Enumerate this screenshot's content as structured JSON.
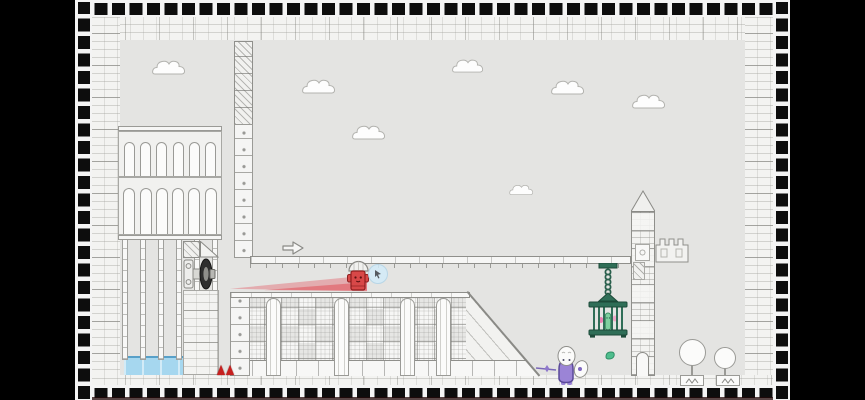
{
  "meta": {
    "app": "2d-platformer-game-scene",
    "scene_description": "Hand-drawn monochrome castle level with black letterbox bars, checkered tile border, brick frame walls, left aqueduct with arches and water pools, a cannon that launched a red player character along a pink dash trail, a suspended walkway with a right-arrow sign, a hanging green cage with captives, a brick tower with battlements, red spikes, a purple NPC with a sword, balloon trees and clouds",
    "visible_text": "none"
  },
  "palette": {
    "letterbox": "#000000",
    "checker_dark": "#0d0d0d",
    "sky": "#e4e4e2",
    "outline": "#8f8f8b",
    "white_fill": "#f9f9f8",
    "water_fill": "#a6d7ef",
    "water_edge": "#58a0c8",
    "spike_red": "#c6201f",
    "player_red": "#d84848",
    "trail_pink": "rgba(226,70,80,0.35)",
    "cage_green": "#2f6e57",
    "captive_green": "#7fcf9f",
    "captive_pink": "#e87fb0",
    "purple_body": "#9b84d6",
    "purple_outline": "#5b4a99"
  },
  "scene": {
    "clouds": [
      {
        "x": 77,
        "y": 58,
        "w": 34
      },
      {
        "x": 227,
        "y": 77,
        "w": 34
      },
      {
        "x": 377,
        "y": 57,
        "w": 32
      },
      {
        "x": 476,
        "y": 78,
        "w": 34
      },
      {
        "x": 557,
        "y": 92,
        "w": 34
      },
      {
        "x": 277,
        "y": 123,
        "w": 34
      },
      {
        "x": 434,
        "y": 183,
        "w": 25
      }
    ],
    "spikes": [
      {
        "x": 142,
        "y": 365
      },
      {
        "x": 151,
        "y": 365
      }
    ],
    "trees": [
      {
        "ballX": 604,
        "ballY": 339,
        "d": 27,
        "stemX": 616,
        "stemY": 365,
        "stemH": 11,
        "baseX": 605,
        "baseY": 375
      },
      {
        "ballX": 639,
        "ballY": 347,
        "d": 22,
        "stemX": 649,
        "stemY": 368,
        "stemH": 8,
        "baseX": 641,
        "baseY": 375
      }
    ],
    "objects": {
      "player": "red-knight-character launched from cannon, standing at trail end",
      "cannon": "dark wheel cannon mounted on aqueduct column",
      "cage": "green hanging cage with pink captives and green pickle figure",
      "npc": "purple blob character with white head, wing-shield and sword pointing left",
      "collectible": "small green leaf gem near tower base",
      "sign": "arrow sign pointing right on walkway"
    }
  }
}
